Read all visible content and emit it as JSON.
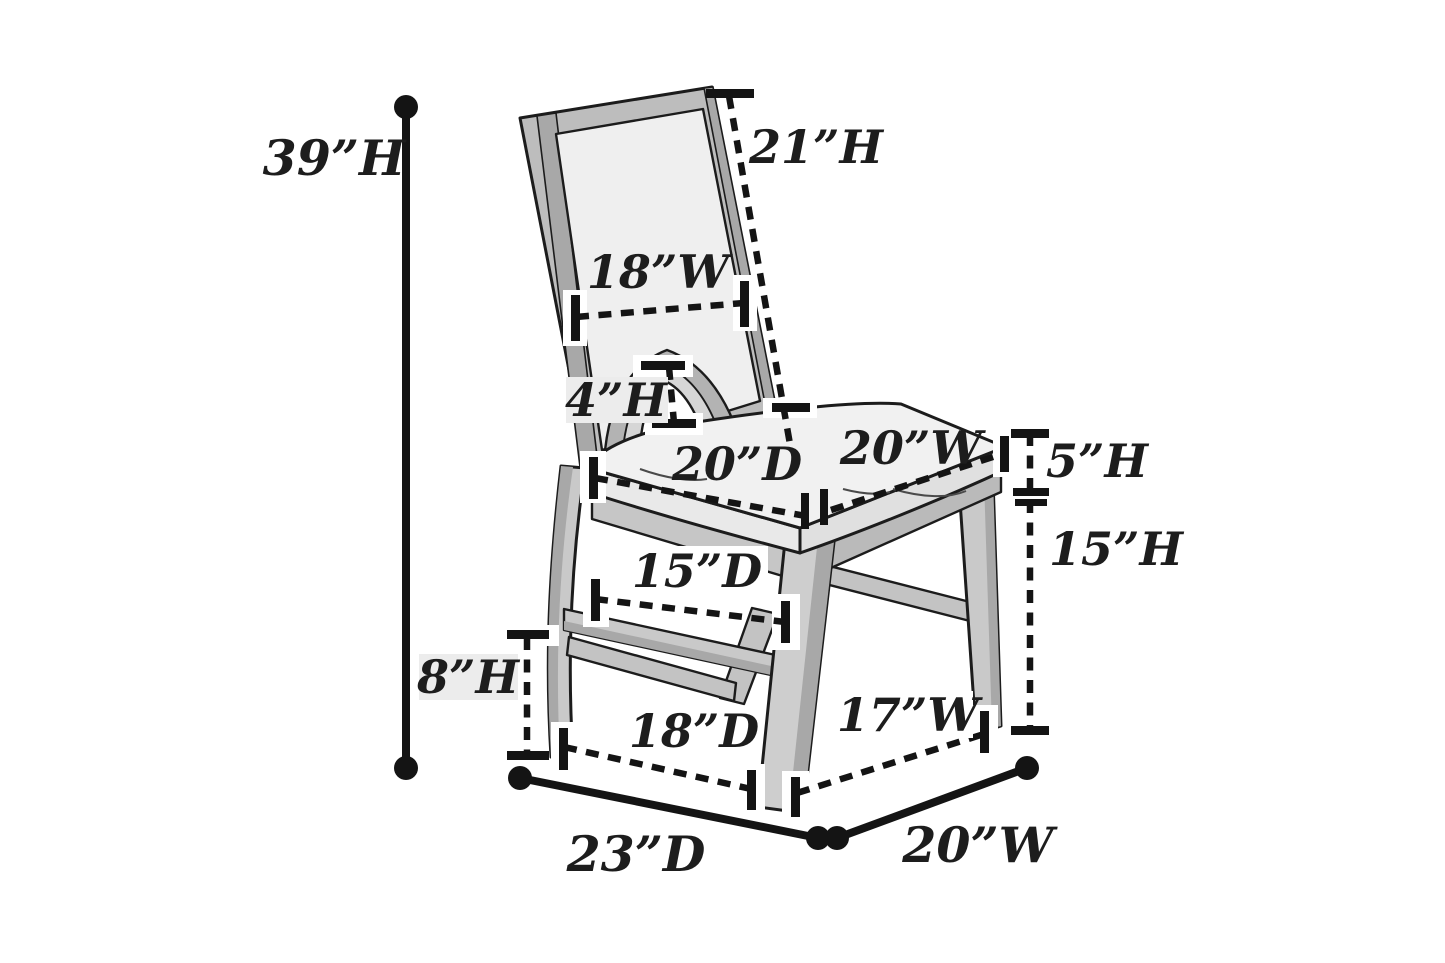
{
  "diagram": {
    "kind": "furniture-dimension-diagram",
    "subject": "dining side chair, three-quarter view line drawing with dimension callouts",
    "units": "inches",
    "background_color": "#ffffff",
    "line_color": "#141414",
    "text_color": "#1d1d1d",
    "chair_fill_light": "#f0f0f0",
    "chair_fill_gray": "#c0c0c0",
    "dimensions": {
      "overall_height": {
        "text": "39”H",
        "inches": 39,
        "measures": "overall height"
      },
      "back_height": {
        "text": "21”H",
        "inches": 21,
        "measures": "backrest height"
      },
      "back_width": {
        "text": "18”W",
        "inches": 18,
        "measures": "backrest width"
      },
      "back_cutout_height": {
        "text": "4”H",
        "inches": 4,
        "measures": "backrest arch cutout height"
      },
      "seat_depth": {
        "text": "20”D",
        "inches": 20,
        "measures": "seat depth"
      },
      "seat_width": {
        "text": "20”W",
        "inches": 20,
        "measures": "seat width"
      },
      "cushion_height": {
        "text": "5”H",
        "inches": 5,
        "measures": "seat cushion thickness"
      },
      "seat_height": {
        "text": "15”H",
        "inches": 15,
        "measures": "floor to seat frame height"
      },
      "stretcher_depth": {
        "text": "15”D",
        "inches": 15,
        "measures": "stretcher depth"
      },
      "stretcher_height": {
        "text": "8”H",
        "inches": 8,
        "measures": "floor to stretcher height"
      },
      "base_depth": {
        "text": "18”D",
        "inches": 18,
        "measures": "leg base depth"
      },
      "base_width": {
        "text": "17”W",
        "inches": 17,
        "measures": "leg base width"
      },
      "overall_depth": {
        "text": "23”D",
        "inches": 23,
        "measures": "overall depth"
      },
      "overall_width": {
        "text": "20”W",
        "inches": 20,
        "measures": "overall width"
      }
    }
  }
}
